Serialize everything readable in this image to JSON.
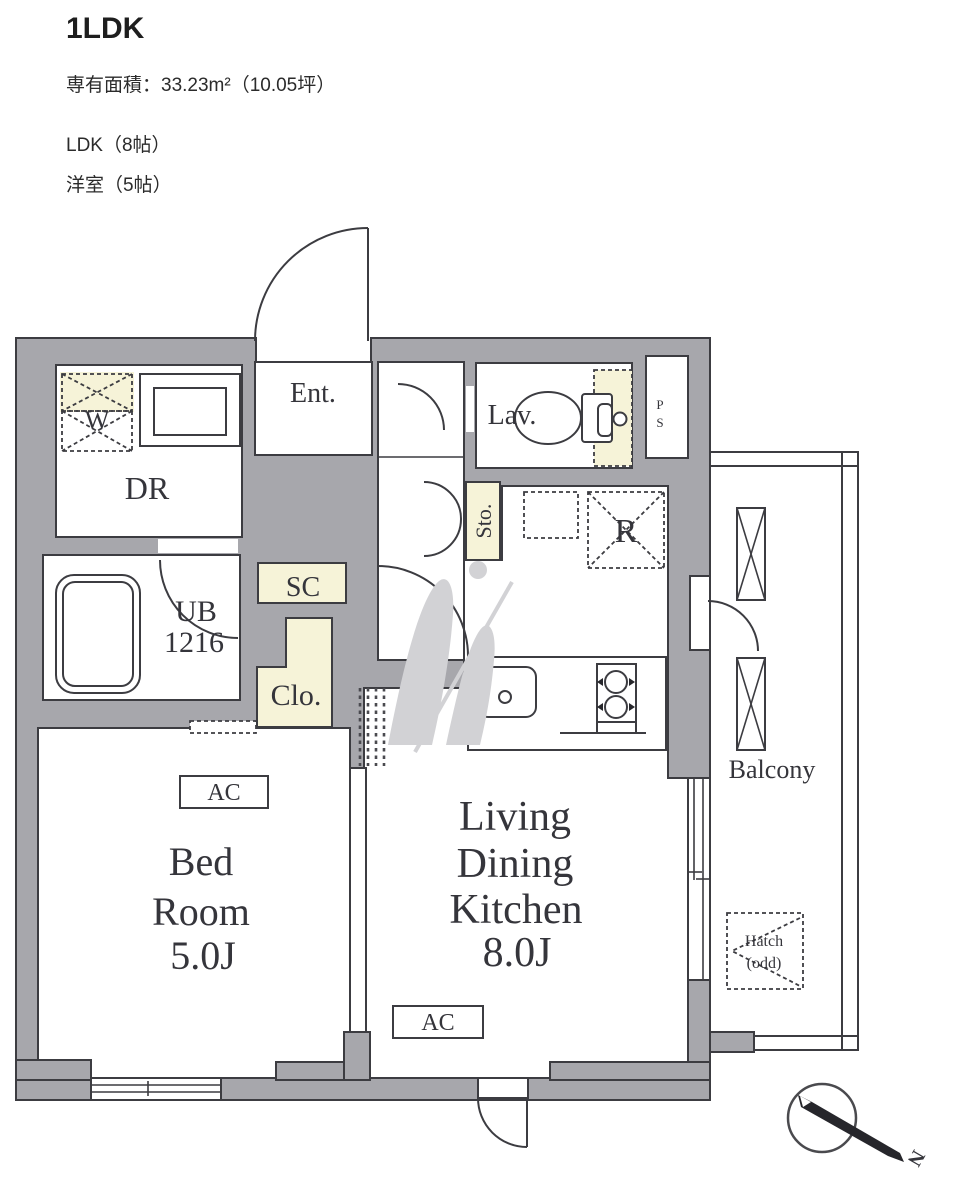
{
  "header": {
    "title": "1LDK",
    "area": "専有面積：33.23m²（10.05坪）",
    "detail_ldk": "LDK（8帖）",
    "detail_room": "洋室（5帖）"
  },
  "floorplan": {
    "labels": {
      "washer": "W",
      "dressing_room": "DR",
      "entrance": "Ent.",
      "lavatory": "Lav.",
      "pipe_shaft_p": "P",
      "pipe_shaft_s": "S",
      "unit_bath_line1": "UB",
      "unit_bath_line2": "1216",
      "shoe_closet": "SC",
      "storage": "Sto.",
      "closet": "Clo.",
      "refrigerator": "R",
      "bedroom_line1": "Bed",
      "bedroom_line2": "Room",
      "bedroom_line3": "5.0J",
      "ldk_line1": "Living",
      "ldk_line2": "Dining",
      "ldk_line3": "Kitchen",
      "ldk_line4": "8.0J",
      "ac": "AC",
      "balcony": "Balcony",
      "hatch_line1": "Hatch",
      "hatch_line2": "(odd)",
      "compass_north": "N"
    },
    "colors": {
      "wall": "#a7a7ac",
      "cream": "#f6f3d8",
      "outline": "#3c3c41",
      "label": "#35353b",
      "watermark": "#d2d2d5"
    }
  }
}
